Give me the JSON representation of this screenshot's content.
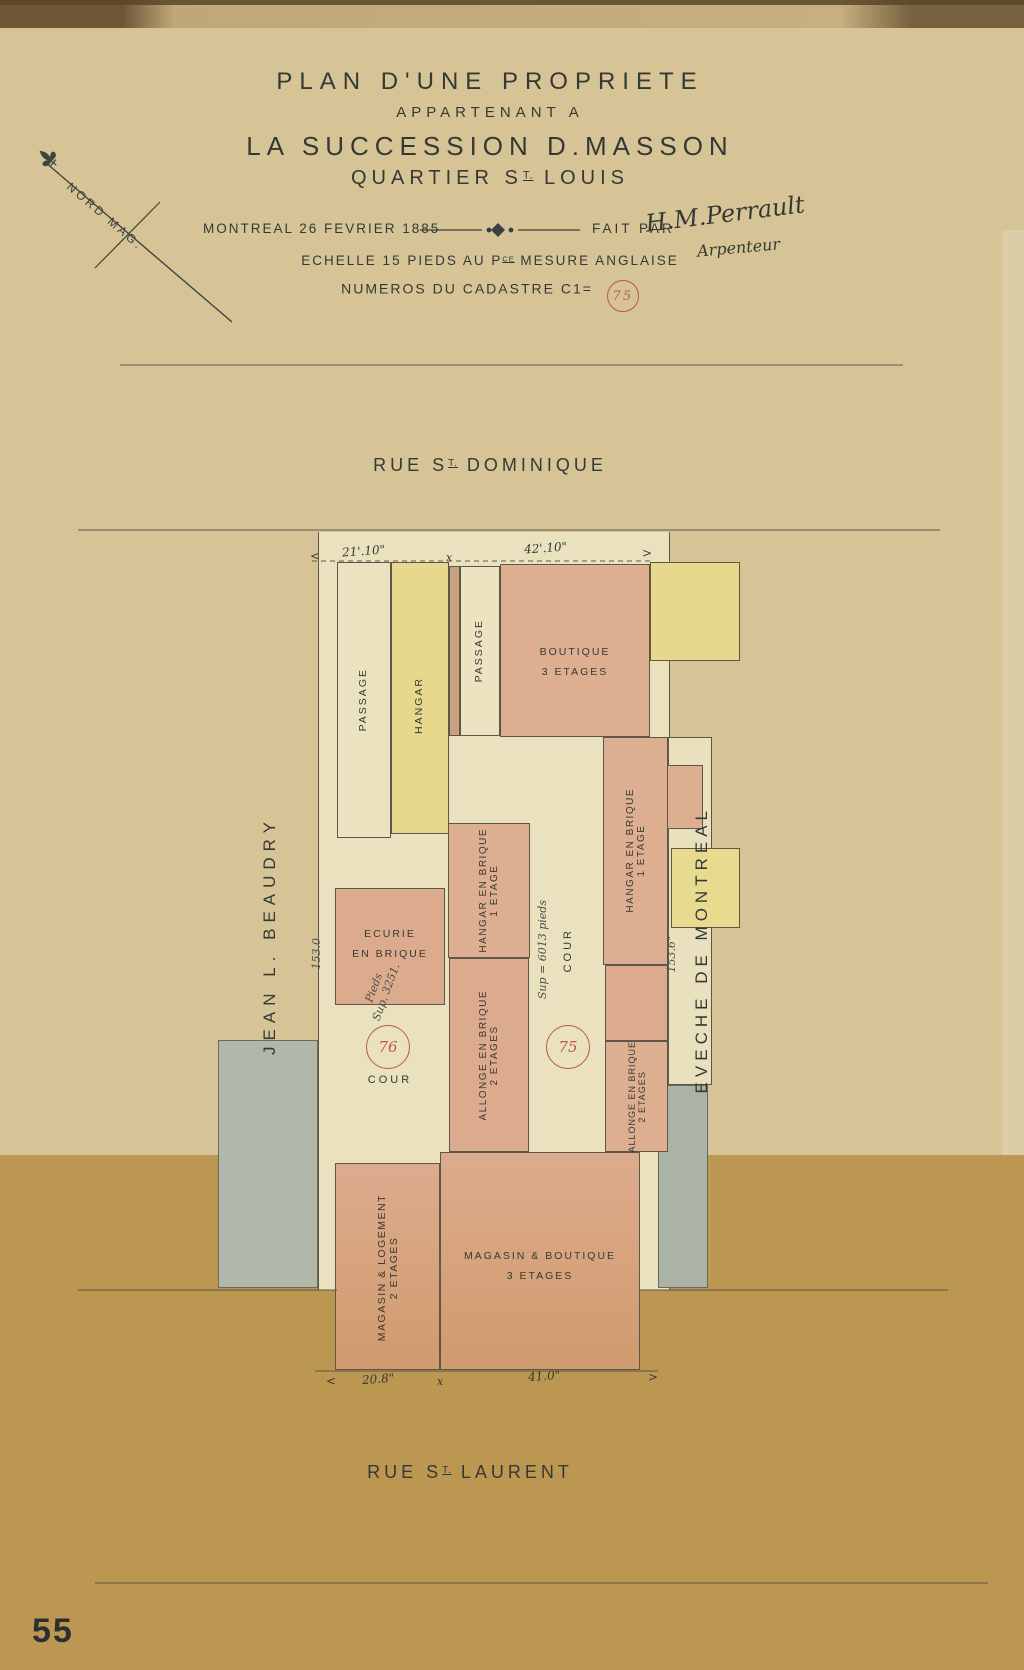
{
  "document": {
    "title": {
      "line1": "PLAN D'UNE PROPRIETE",
      "line2": "APPARTENANT A",
      "line3": "LA SUCCESSION D.MASSON",
      "line4_prefix": "QUARTIER S",
      "line4_sup": "T.",
      "line4_rest": "LOUIS"
    },
    "meta": {
      "place_date": "MONTREAL 26 FEVRIER 1885",
      "fait_par": "FAIT PAR",
      "signature": "H.M.Perrault",
      "signature_role": "Arpenteur"
    },
    "scale": {
      "prefix": "ECHELLE 15 PIEDS AU P",
      "sup": "CE",
      "rest": "MESURE ANGLAISE"
    },
    "cadastre": {
      "label": "NUMEROS DU CADASTRE C1=",
      "number": "75"
    },
    "compass_label": "NORD MAG.",
    "page_number": "55"
  },
  "streets": {
    "top_prefix": "RUE S",
    "top_sup": "T.",
    "top_rest": "DOMINIQUE",
    "bottom_prefix": "RUE S",
    "bottom_sup": "T.",
    "bottom_rest": "LAURENT"
  },
  "neighbors": {
    "left": "JEAN L. BEAUDRY",
    "right": "EVECHE DE MONTREAL"
  },
  "dimensions": {
    "top_left": "21'.10\"",
    "top_right": "42'.10\"",
    "bottom_left": "20.8\"",
    "bottom_right": "41.0\"",
    "side_left": "153.0",
    "side_right": "153.6\"",
    "x_mark": "x",
    "arrow_left": "<",
    "arrow_right": ">"
  },
  "blocks": {
    "passage_left": {
      "label": "PASSAGE"
    },
    "hangar": {
      "label": "HANGAR"
    },
    "passage_mid": {
      "label": "PASSAGE"
    },
    "boutique": {
      "line1": "BOUTIQUE",
      "line2": "3 ETAGES"
    },
    "ecurie": {
      "line1": "ECURIE",
      "line2": "EN BRIQUE",
      "note_line1": "Pieds",
      "note_line2": "Sup. 3251."
    },
    "cour_left": {
      "number": "76",
      "label": "COUR"
    },
    "hangar_brique_left": {
      "line1": "HANGAR EN BRIQUE",
      "line2": "1 ETAGE"
    },
    "allonge_left": {
      "line1": "ALLONGE EN BRIQUE",
      "line2": "2 ETAGES"
    },
    "cour_mid": {
      "note": "Sup = 6013 pieds",
      "label": "COUR",
      "number": "75"
    },
    "hangar_brique_right": {
      "line1": "HANGAR EN BRIQUE",
      "line2": "1 ETAGE"
    },
    "allonge_right": {
      "line1": "ALLONGE EN BRIQUE",
      "line2": "2 ETAGES"
    },
    "magasin_logement": {
      "line1": "MAGASIN & LOGEMENT",
      "line2": "2 ETAGES"
    },
    "magasin_boutique": {
      "line1": "MAGASIN & BOUTIQUE",
      "line2": "3 ETAGES"
    }
  },
  "colors": {
    "paper": "#d6c496",
    "paper_dark": "#bb9752",
    "lot_cream": "#eae1bf",
    "block_yellow": "#e6d88c",
    "block_salmon": "#deae90",
    "block_grey": "#b1b7a9",
    "ink": "#343a33",
    "red": "#bf5647"
  }
}
